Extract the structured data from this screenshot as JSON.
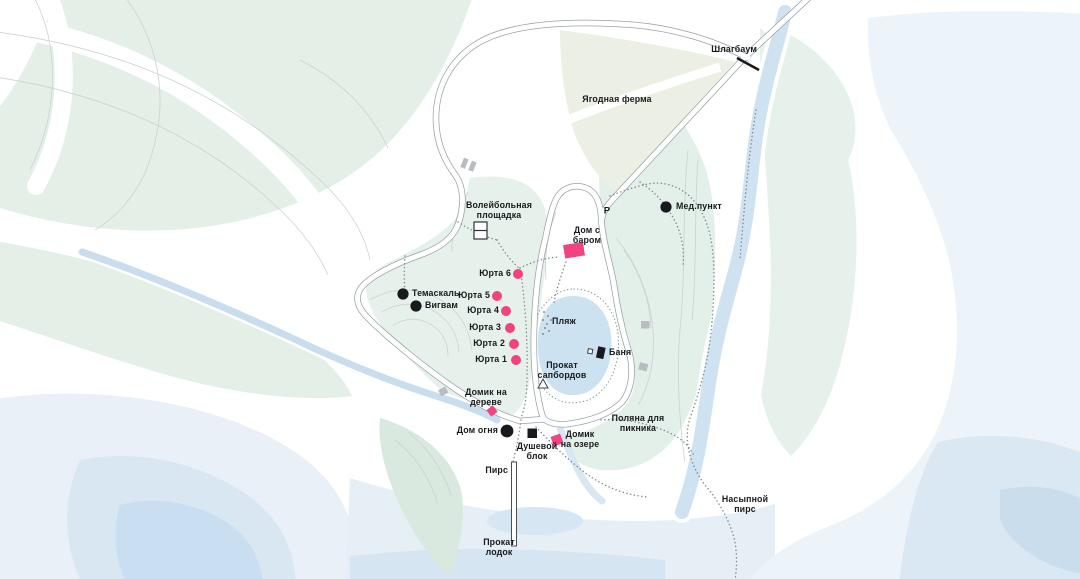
{
  "map": {
    "labels": {
      "shlagbaum": "Шлагбаум",
      "berry_farm": "Ягодная ферма",
      "medpunkt": "Мед.пункт",
      "parking": "Р",
      "volleyball": "Волейбольная\nплощадка",
      "dom_s_barom": "Дом с\nбаром",
      "yurta6": "Юрта 6",
      "yurta5": "Юрта 5",
      "yurta4": "Юрта 4",
      "yurta3": "Юрта 3",
      "yurta2": "Юрта 2",
      "yurta1": "Юрта 1",
      "temaskal": "Темаскаль",
      "wigwam": "Вигвам",
      "plyazh": "Пляж",
      "banya": "Баня",
      "sup_rental": "Прокат\nсапбордов",
      "treehouse": "Домик на\nдереве",
      "dom_ognya": "Дом огня",
      "shower_block": "Душевой\nблок",
      "lake_house": "Домик\nна озере",
      "pirs": "Пирс",
      "boat_rental": "Прокат\nлодок",
      "picnic_glade": "Поляна для\nпикника",
      "nasypnoy_pirs": "Насыпной\nпирс"
    },
    "colors": {
      "accent_pink": "#f2427f",
      "marker_black": "#17191c",
      "building_gray": "#b9bdc1",
      "forest_green": "#e4efe8",
      "lake_blue": "#cde2f1",
      "pale_water": "#e9f1f8",
      "road_casing": "#9aa0a5"
    },
    "markers": {
      "yurt": {
        "shape": "circle",
        "color": "#f2427f"
      },
      "guest_house": {
        "shape": "square",
        "color": "#f2427f"
      },
      "poi": {
        "shape": "circle",
        "color": "#17191c"
      },
      "service": {
        "shape": "square",
        "color": "#17191c"
      },
      "building": {
        "shape": "square",
        "color": "#b9bdc1"
      },
      "barrier": {
        "shape": "diagonal-line",
        "color": "#17191c"
      }
    }
  }
}
